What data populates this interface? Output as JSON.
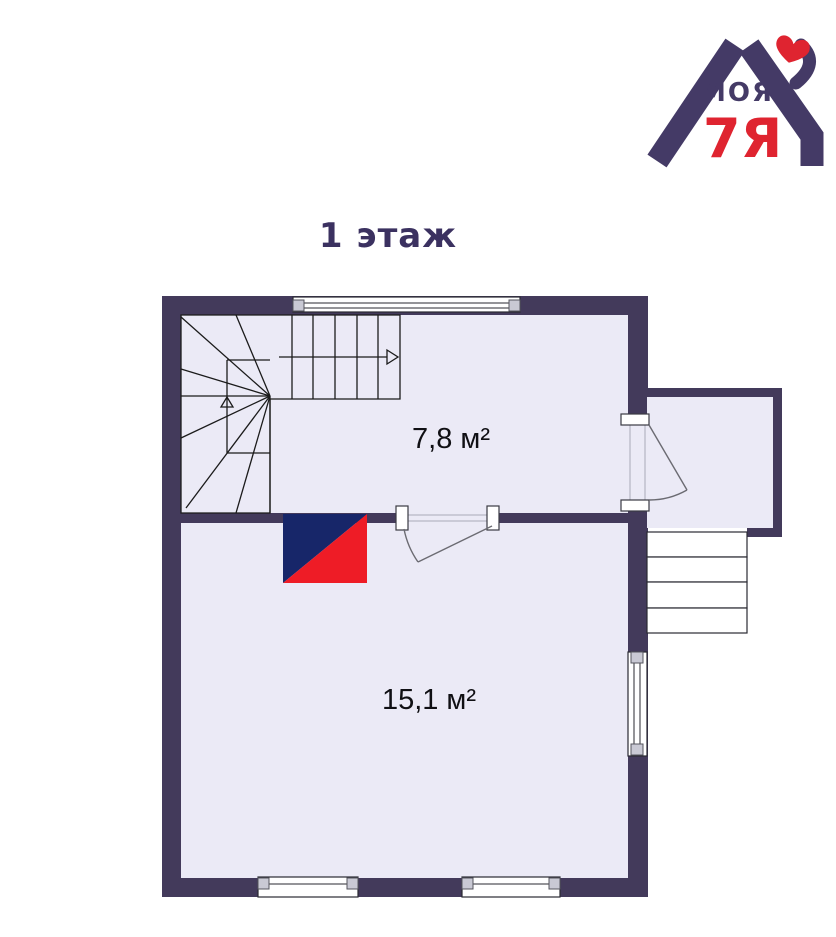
{
  "title": "1 этаж",
  "logo": {
    "text_top": "МОЯ",
    "text_bottom": "7Я",
    "icons": {
      "heart": "♥"
    },
    "colors": {
      "purple": "#443a66",
      "red": "#df2430"
    }
  },
  "floor_plan": {
    "rooms": [
      {
        "area_label": "7,8 м²"
      },
      {
        "area_label": "15,1 м²"
      }
    ],
    "colors": {
      "wall": "#433a5b",
      "room_fill": "#ebeaf6",
      "stairs_fill": "#ffffff",
      "plan_line": "#1b1b1b",
      "door_line": "#6b6b72",
      "window_cap": "#c9c9d4",
      "stove_navy": "#172669",
      "stove_red": "#ee1c26"
    }
  }
}
